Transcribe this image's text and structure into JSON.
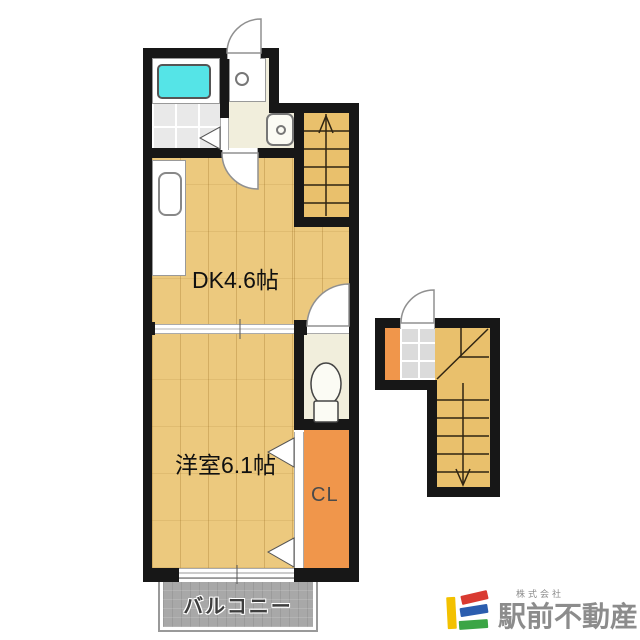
{
  "rooms": {
    "dining_kitchen": {
      "label": "DK4.6帖"
    },
    "western_room": {
      "label": "洋室6.1帖"
    },
    "closet": {
      "label": "CL"
    },
    "balcony": {
      "label": "バルコニー"
    }
  },
  "fixtures": [
    "bathtub",
    "shower-tile-floor",
    "vanity-basin",
    "washing-machine-pan",
    "kitchen-counter-sink",
    "toilet",
    "entrance-door",
    "interior-door",
    "sliding-door",
    "bifold-bathroom-door",
    "bifold-closet-door",
    "balcony-window",
    "staircase-up-arrow",
    "staircase-down-arrow",
    "genkan-tile"
  ],
  "colors": {
    "wall": "#171717",
    "wood_floor": "#ECC97E",
    "stairs_floor": "#E9C06C",
    "cream_floor": "#F1EEDC",
    "closet_orange": "#F0964B",
    "bathtub_cyan": "#55E4E7",
    "balcony_gray": "#A8A8A8",
    "genkan_tile_gray": "#DBDBDB"
  },
  "logo": {
    "prefix": "株式会社",
    "name": "駅前不動産",
    "text_color": "#8C8C8C",
    "mark_colors": {
      "yellow": "#F3C100",
      "red": "#D93A31",
      "blue": "#2B5DAE",
      "green": "#3BA545"
    }
  }
}
